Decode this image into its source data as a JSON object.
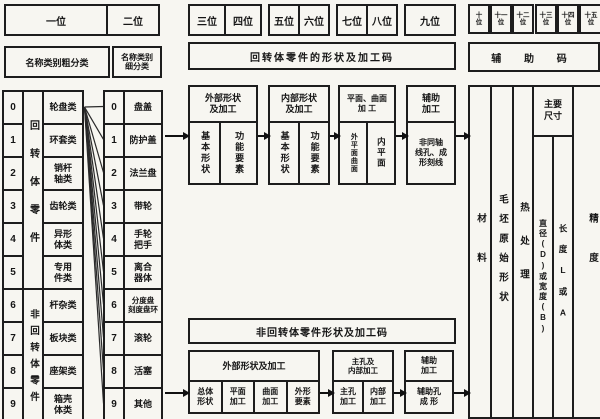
{
  "top": {
    "bits": [
      "一位",
      "二位",
      "三位",
      "四位",
      "五位",
      "六位",
      "七位",
      "八位",
      "九位"
    ],
    "bits_high": [
      [
        "十",
        "位"
      ],
      [
        "十一",
        "位"
      ],
      [
        "十二",
        "位"
      ],
      [
        "十三",
        "位"
      ],
      [
        "十四",
        "位"
      ],
      [
        "十五",
        "位"
      ]
    ]
  },
  "headers": {
    "coarse": "名称类别粗分类",
    "fine": "名称类别\n细分类",
    "rotational_code": "回转体零件的形状及加工码",
    "auxiliary_code": "辅 助 码",
    "non_rotational_code": "非回转体零件形状及加工码"
  },
  "classification": {
    "digits": [
      "0",
      "1",
      "2",
      "3",
      "4",
      "5",
      "6",
      "7",
      "8",
      "9"
    ],
    "group_labels": {
      "rotational": "回转体零件",
      "non_rotational": "非回转体零件"
    },
    "categories": [
      "轮盘类",
      "环套类",
      "销杆\n轴类",
      "齿轮类",
      "异形\n体类",
      "专用\n件类",
      "杆杂类",
      "板块类",
      "座架类",
      "箱壳\n体类"
    ],
    "subcategories": [
      "盘盖",
      "防护盖",
      "法兰盘",
      "带轮",
      "手轮\n把手",
      "离合\n器体",
      "分度盘\n刻度盘环",
      "滚轮",
      "活塞",
      "其他"
    ]
  },
  "rotational_flow": {
    "external": {
      "title": "外部形状\n及加工",
      "sub1": "基本形状",
      "sub2": "功能要素"
    },
    "internal": {
      "title": "内部形状\n及加工",
      "sub1": "基本形状",
      "sub2": "功能要素"
    },
    "surface": {
      "title": "平面、曲面\n加 工",
      "sub1": "外平面曲面",
      "sub2": "内平面"
    },
    "auxiliary": {
      "title": "辅助\n加工",
      "sub1": "非同轴\n线孔、成\n形刻线"
    }
  },
  "non_rotational_flow": {
    "external": {
      "title": "外部形状及加工",
      "sub1": "总体\n形状",
      "sub2": "平面\n加工",
      "sub3": "曲面\n加工",
      "sub4": "外形\n要素"
    },
    "main_hole": {
      "title": "主孔及\n内部加工",
      "sub1": "主孔\n加工",
      "sub2": "内部\n加工"
    },
    "auxiliary": {
      "title": "辅助\n加工",
      "sub1": "辅助孔\n成 形"
    }
  },
  "aux_section": {
    "material": "材料",
    "blank_shape": "毛坯原始形状",
    "heat_treatment": "热处理",
    "main_dims": "主要\n尺寸",
    "diameter": "直径(D)或宽度(B)",
    "length": "长度L或A",
    "precision": "精度"
  }
}
